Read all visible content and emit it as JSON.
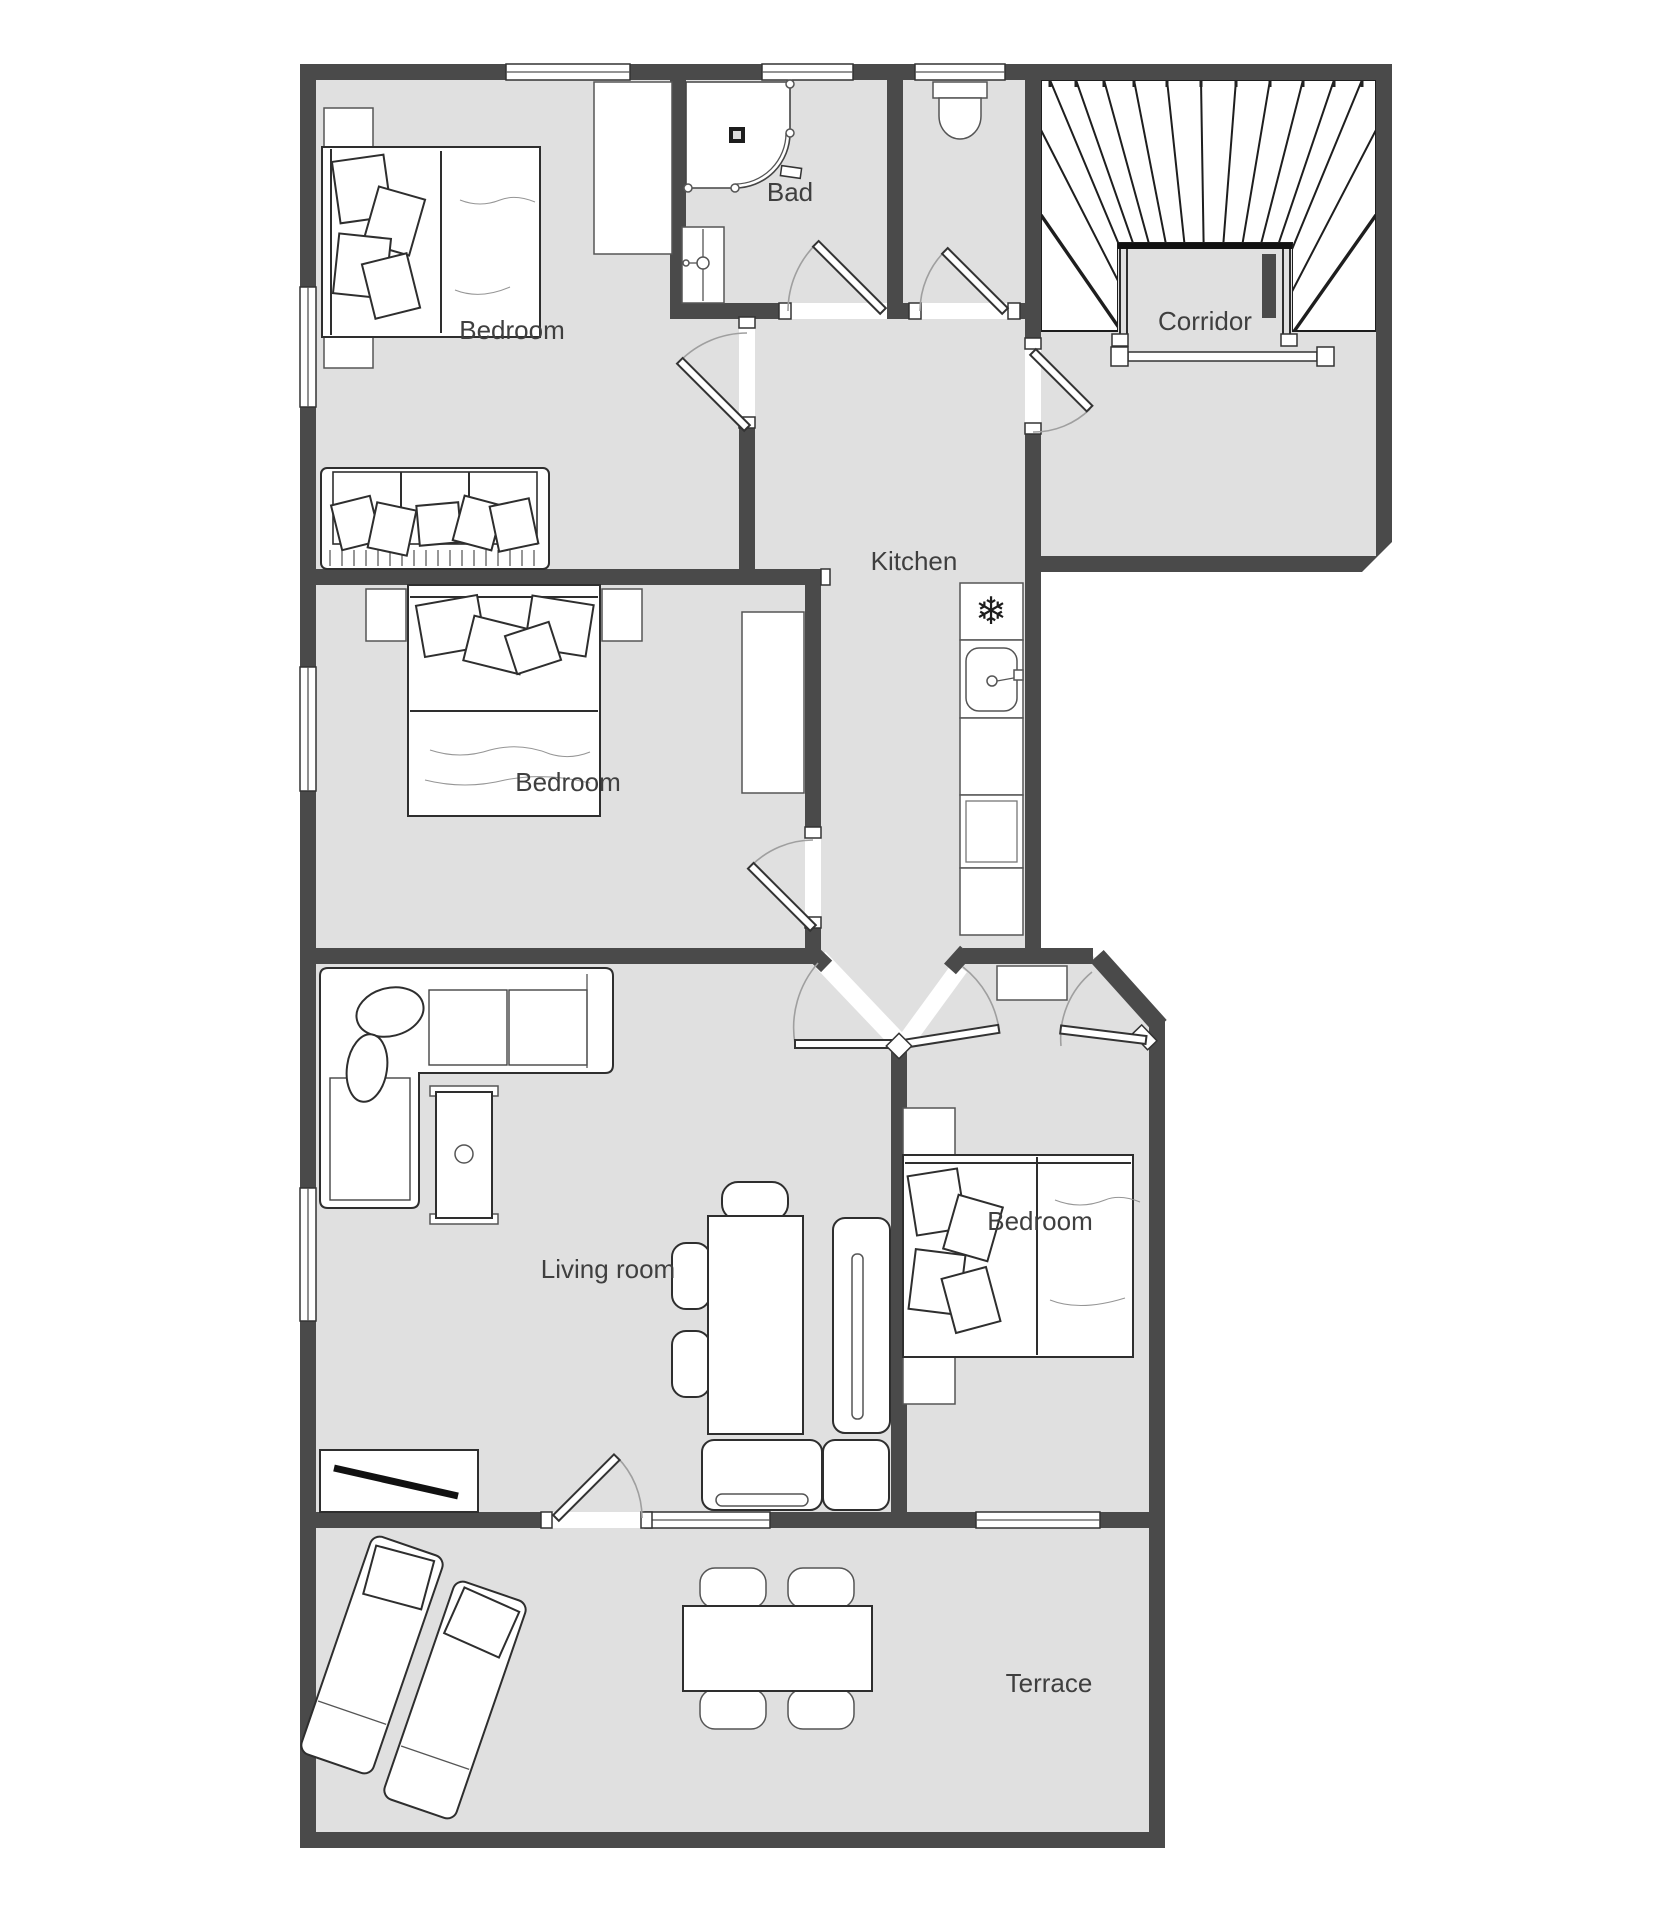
{
  "plan": {
    "type": "apartment-floor-plan",
    "rooms": [
      {
        "name": "bedroom-top-left",
        "label": "Bedroom"
      },
      {
        "name": "bathroom",
        "label": "Bad"
      },
      {
        "name": "corridor",
        "label": "Corridor"
      },
      {
        "name": "kitchen",
        "label": "Kitchen"
      },
      {
        "name": "bedroom-middle",
        "label": "Bedroom"
      },
      {
        "name": "living-room",
        "label": "Living room"
      },
      {
        "name": "bedroom-right",
        "label": "Bedroom"
      },
      {
        "name": "terrace",
        "label": "Terrace"
      }
    ],
    "icons": {
      "freezer": "❄"
    },
    "colors": {
      "wall": "#4a4a4a",
      "floor": "#e0e0e0",
      "furniture_outline": "#2e2e2e",
      "label": "#3f3f3f",
      "door_arc": "#9f9f9f",
      "background": "#ffffff"
    }
  }
}
